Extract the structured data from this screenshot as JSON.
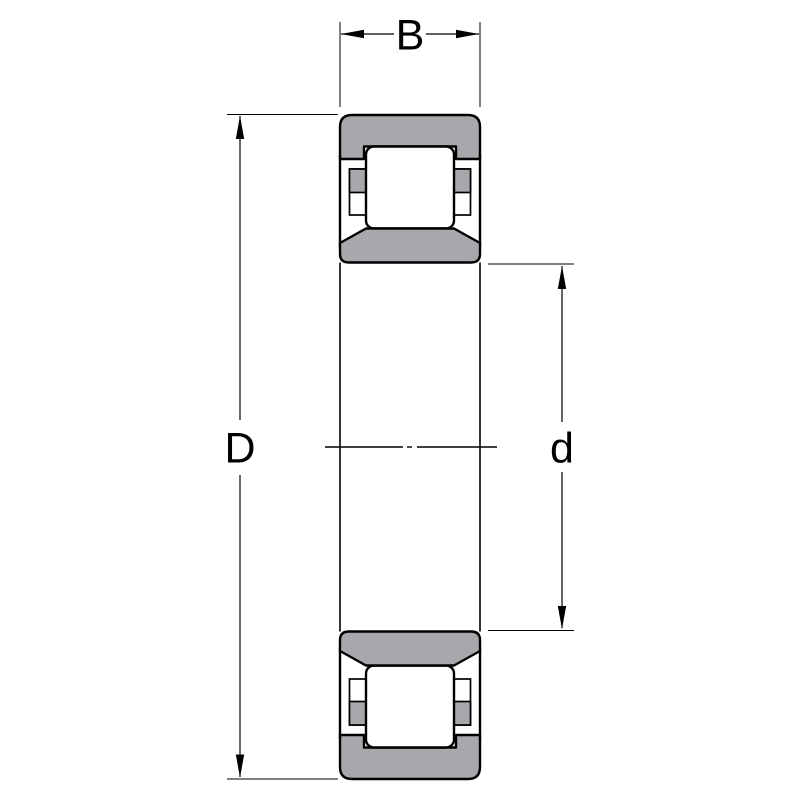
{
  "diagram": {
    "labels": {
      "width": "B",
      "outer_diameter": "D",
      "bore_diameter": "d"
    },
    "colors": {
      "ring_fill": "#a6a8ab",
      "roller_fill": "#ffffff",
      "line": "#000000",
      "background": "#ffffff"
    }
  }
}
